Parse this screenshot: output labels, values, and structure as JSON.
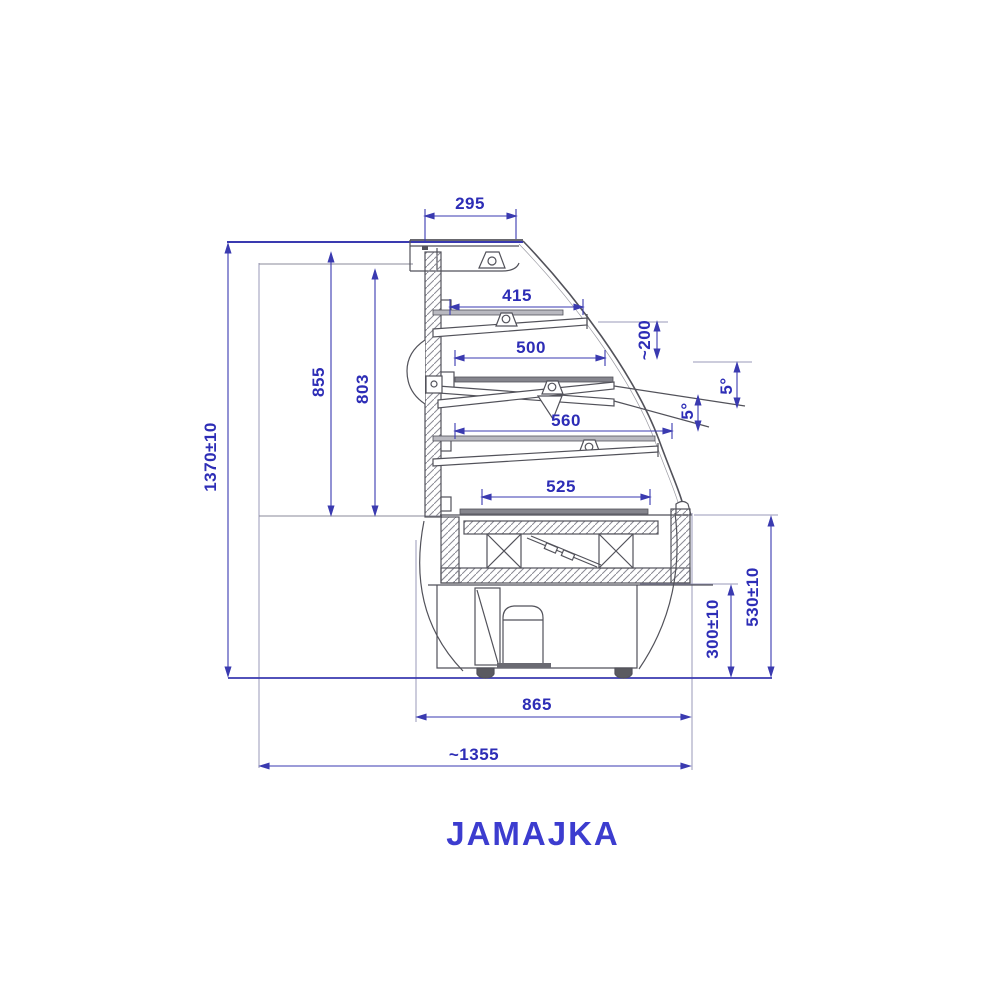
{
  "title": "JAMAJKA",
  "colors": {
    "dimension_color": "#2d2db6",
    "title_color": "#3c3ccf",
    "drawing_line_color": "#52525a"
  },
  "dimensions": {
    "canopy_depth": "295",
    "shelf1_width": "415",
    "shelf2_width": "500",
    "shelf3_width": "560",
    "base_shelf_width": "525",
    "shelf_spacing": "~200",
    "shelf_tilt_inner": "5°",
    "shelf_tilt_outer": "5°",
    "inner_height_a": "855",
    "inner_height_b": "803",
    "total_height": "1370±10",
    "base_bottom_height": "300±10",
    "base_height": "530±10",
    "base_depth": "865",
    "total_depth": "~1355"
  }
}
